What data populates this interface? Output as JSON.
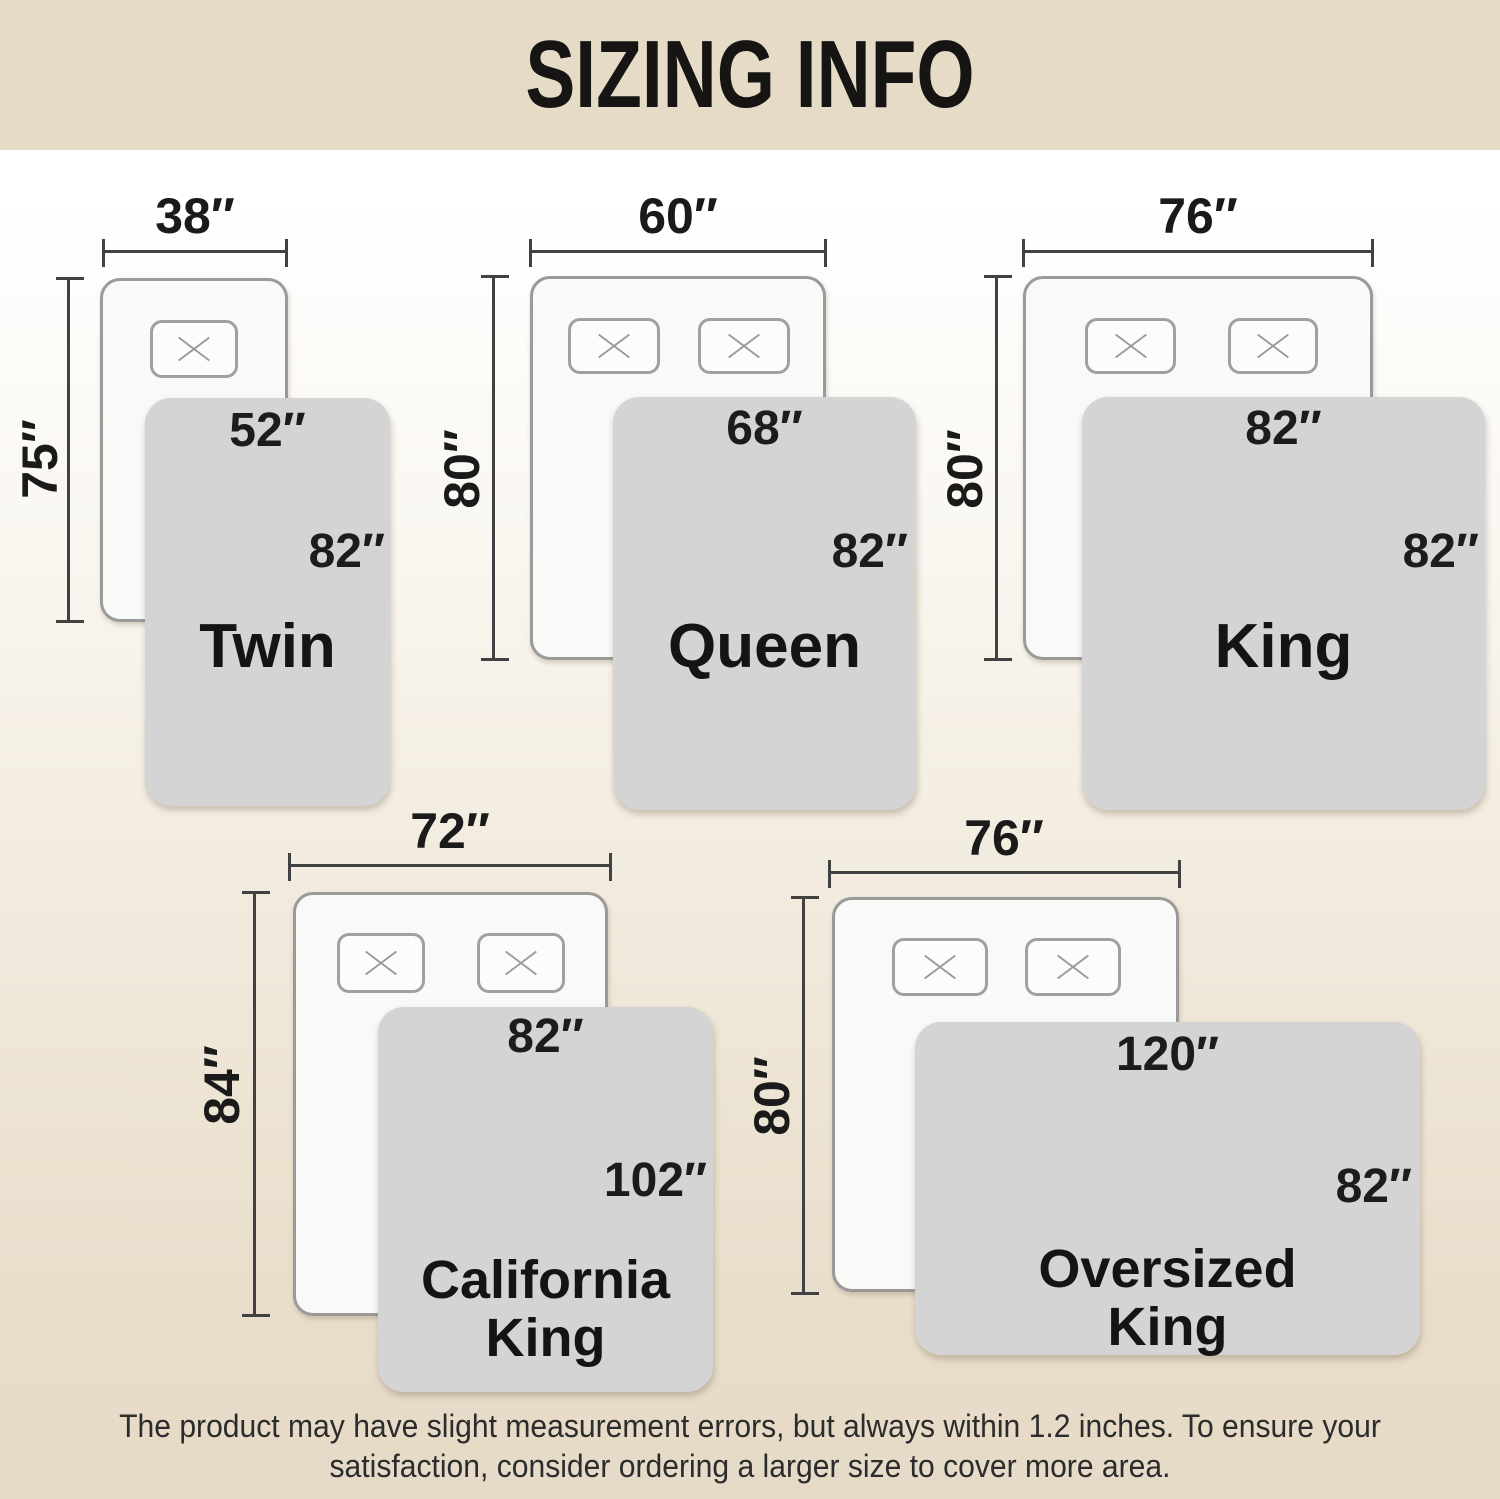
{
  "title": "SIZING INFO",
  "footer": {
    "line1": "The product may have slight measurement errors, but always within 1.2 inches. To ensure your",
    "line2": "satisfaction, consider ordering a larger size to cover more area."
  },
  "colors": {
    "header_band": "#e6dbc6",
    "background_bottom": "#e6dac7",
    "blanket_gray": "#d3d4d3",
    "bed_fill": "#f9f9f8",
    "bed_border": "#9a9a9a",
    "dimension_line": "#414141",
    "text_black": "#1a1a1a"
  },
  "panels": [
    {
      "name": "Twin",
      "name_line1": "Twin",
      "name_line2": "",
      "bed_width": "38″",
      "bed_length": "75″",
      "blanket_width": "52″",
      "blanket_length": "82″",
      "pillows": 1
    },
    {
      "name": "Queen",
      "name_line1": "Queen",
      "name_line2": "",
      "bed_width": "60″",
      "bed_length": "80″",
      "blanket_width": "68″",
      "blanket_length": "82″",
      "pillows": 2
    },
    {
      "name": "King",
      "name_line1": "King",
      "name_line2": "",
      "bed_width": "76″",
      "bed_length": "80″",
      "blanket_width": "82″",
      "blanket_length": "82″",
      "pillows": 2
    },
    {
      "name": "California King",
      "name_line1": "California",
      "name_line2": "King",
      "bed_width": "72″",
      "bed_length": "84″",
      "blanket_width": "82″",
      "blanket_length": "102″",
      "pillows": 2
    },
    {
      "name": "Oversized King",
      "name_line1": "Oversized",
      "name_line2": "King",
      "bed_width": "76″",
      "bed_length": "80″",
      "blanket_width": "120″",
      "blanket_length": "82″",
      "pillows": 2
    }
  ]
}
